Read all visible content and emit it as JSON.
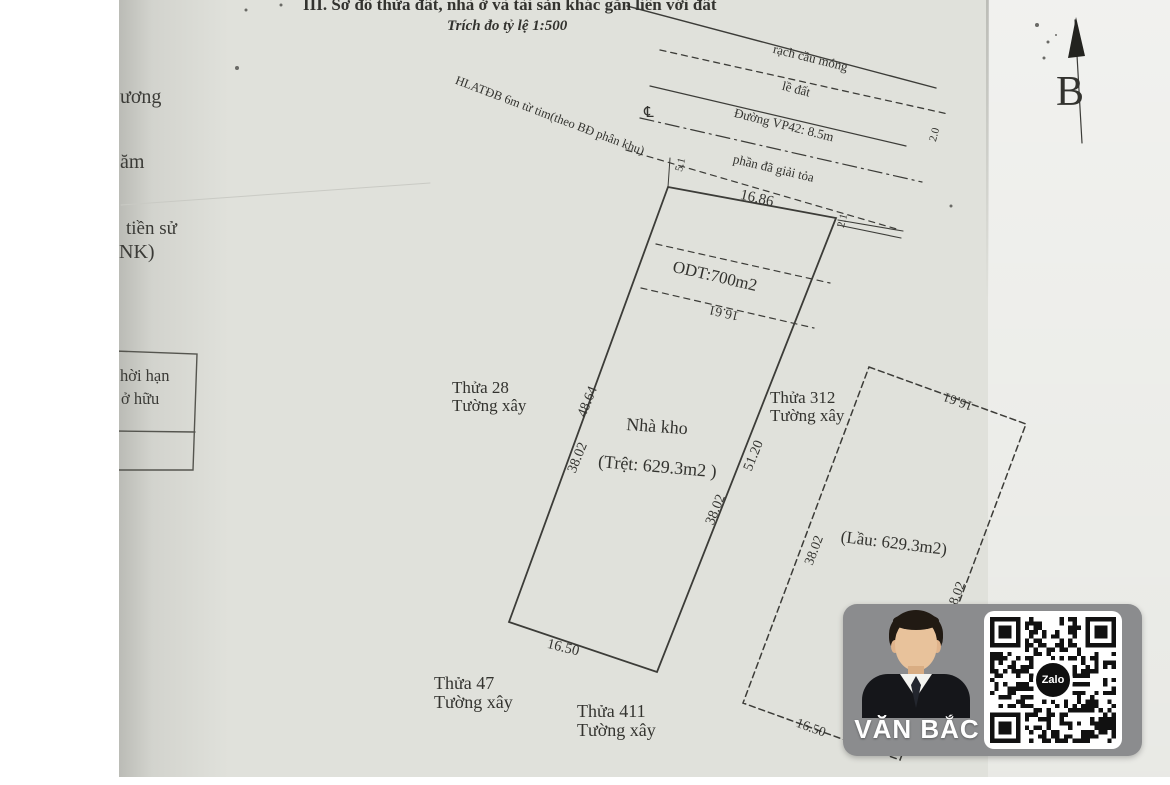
{
  "document": {
    "section_title": "III. Sơ đồ thửa đất, nhà ở và tài sản khác gắn liền với đất",
    "scale_note": "Trích đo tỷ lệ  1:500",
    "compass_label": "B"
  },
  "margin_fragments": {
    "f1": "ương",
    "f2": "ăm",
    "f3": "tiền sử",
    "f4": "NK)",
    "box_row1": "hời hạn",
    "box_row2": "ở hữu"
  },
  "map": {
    "road_labels": {
      "canal": "rạch cầu móng",
      "curb": "lề đất",
      "road": "Đường VP42: 8.5m",
      "safety_corridor": "HLATĐB 6m từ tim(theo BĐ phân khu)",
      "cleared_strip": "phần đã giải tỏa"
    },
    "parcel": {
      "landuse_area": "ODT:700m2",
      "building": "Nhà kho",
      "ground_floor_area": "(Trệt: 629.3m2 )",
      "upper_floor_area": "(Lầu: 629.3m2)"
    },
    "dimensions": {
      "top": "16.86",
      "odt_width": "16.61",
      "left_upper": "48.64",
      "left_lower": "38.02",
      "right_upper": "51.20",
      "right_lower": "38.02",
      "bottom": "16.50",
      "annex_top": "16.61",
      "annex_left": "38.02",
      "annex_right": "38.02",
      "annex_bottom": "16.50",
      "offset_a": "5.1",
      "offset_b": "2.1",
      "offset_c": "2.0",
      "centerline_symbol": "℄"
    },
    "neighbors": [
      {
        "name": "Thửa 28",
        "boundary": "Tường xây"
      },
      {
        "name": "Thửa 312",
        "boundary": "Tường xây"
      },
      {
        "name": "Thửa 47",
        "boundary": "Tường xây"
      },
      {
        "name": "Thửa 411",
        "boundary": "Tường xây"
      }
    ]
  },
  "watermark": {
    "agent_name": "VĂN BẮC",
    "qr_brand": "Zalo"
  }
}
